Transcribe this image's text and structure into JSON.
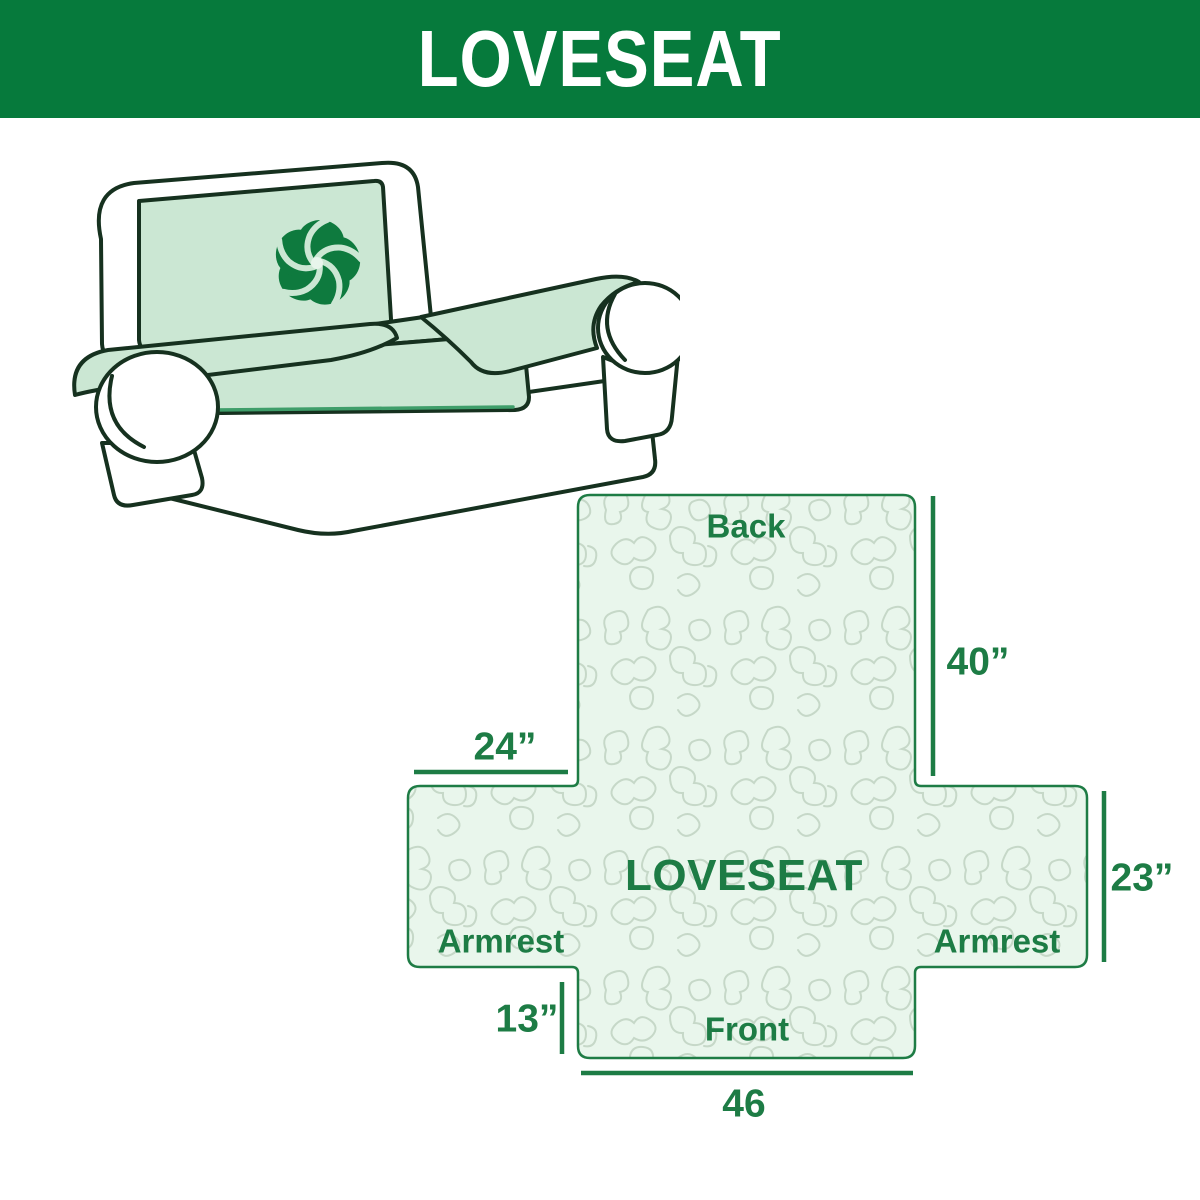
{
  "header": {
    "title": "LOVESEAT",
    "bg_color": "#067a3c",
    "text_color": "#ffffff"
  },
  "sofa": {
    "description": "loveseat sofa line illustration with mint slipcover and pinwheel logo",
    "cover_color": "#cbe7d3",
    "body_color": "#ffffff",
    "outline_color": "#16311f",
    "logo": "pinwheel-icon",
    "logo_color": "#0e7a3e"
  },
  "diagram": {
    "center_label": "LOVESEAT",
    "sections": {
      "back": "Back",
      "front": "Front",
      "armrest_left": "Armrest",
      "armrest_right": "Armrest"
    },
    "dimensions": {
      "back_height": "40”",
      "armrest_top_width": "24”",
      "side_height": "23”",
      "front_drop": "13”",
      "front_width": "46"
    },
    "fill_color": "#e9f6ec",
    "pattern_color": "#c6d8c8",
    "border_color": "#1e7c45",
    "text_color": "#1d7c45",
    "line_color": "#1d7c45"
  }
}
